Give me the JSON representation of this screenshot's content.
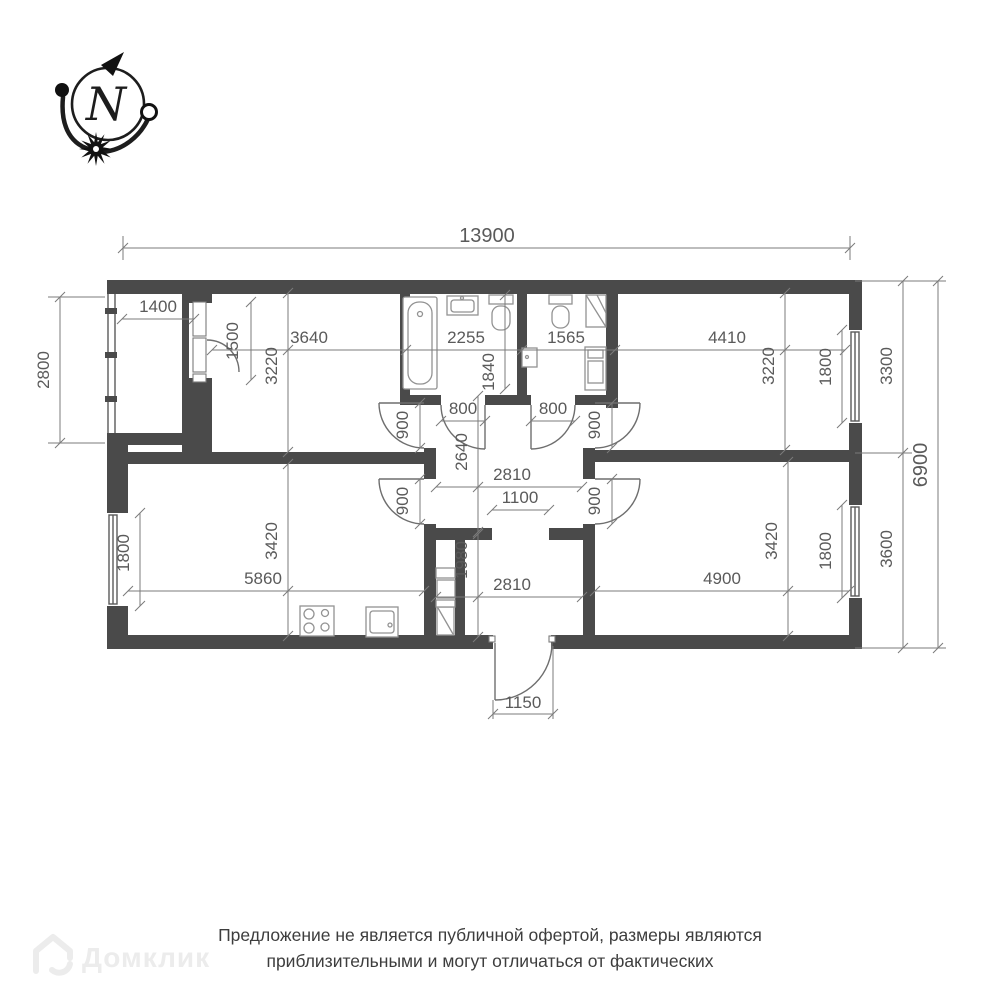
{
  "compass": {
    "north": "N"
  },
  "dimensions": {
    "total_width": "13900",
    "balcony_height": "2800",
    "balcony_width": "1400",
    "balcony_door": "1500",
    "room_tl_width": "3640",
    "room_tl_depth": "3220",
    "bathroom_width": "2255",
    "bathroom_depth": "1840",
    "wc_width": "1565",
    "bedroom_tr_width": "4410",
    "bedroom_tr_depth": "3220",
    "window_tr": "1800",
    "section_right_top": "3300",
    "total_height": "6900",
    "section_right_bottom": "3600",
    "door_bath": "800",
    "door_wc": "800",
    "door_room_tl": "900",
    "door_bedroom_tr": "900",
    "door_living": "900",
    "door_bedroom_br": "900",
    "hall_depth": "2640",
    "hall_width": "2810",
    "hall_opening": "1100",
    "closet_depth": "1980",
    "hall_lower_width": "2810",
    "living_width": "5860",
    "living_depth": "3420",
    "window_left": "1800",
    "bedroom_br_width": "4900",
    "bedroom_br_depth": "3420",
    "window_br": "1800",
    "entry_width": "1150"
  },
  "watermark": {
    "brand": "Домклик"
  },
  "disclaimer": {
    "line1": "Предложение не является публичной офертой, размеры являются",
    "line2": "приблизительными и могут отличаться от фактических"
  }
}
